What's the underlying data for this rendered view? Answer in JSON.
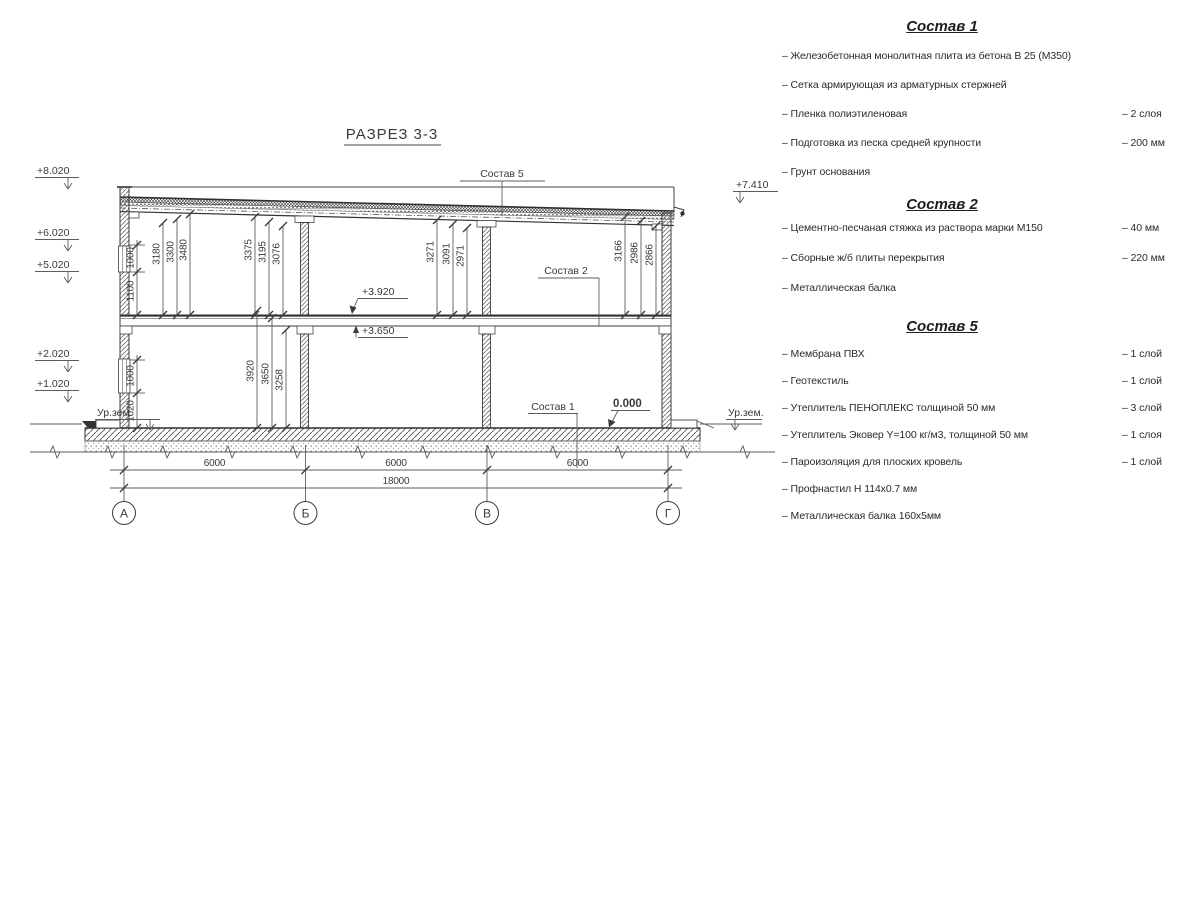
{
  "title": "РАЗРЕЗ 3-3",
  "drawing": {
    "axes": [
      "А",
      "Б",
      "В",
      "Г"
    ],
    "elev_left": [
      "+8.020",
      "+6.020",
      "+5.020",
      "+2.020",
      "+1.020",
      "Ур.зем."
    ],
    "elev_right": [
      "+7.410",
      "Ур.зем."
    ],
    "levels": [
      "+3.920",
      "+3.650",
      "0.000"
    ],
    "leaders": [
      "Состав 5",
      "Состав 2",
      "Состав 1"
    ],
    "dims": {
      "upper_left": [
        "1000",
        "1100"
      ],
      "bay1": [
        "3180",
        "3300",
        "3480"
      ],
      "bay1r": [
        "3375",
        "3195",
        "3076"
      ],
      "bay2": [
        "3271",
        "3091",
        "2971"
      ],
      "bay3": [
        "3166",
        "2986",
        "2866"
      ],
      "lower_left": [
        "1000",
        "1020"
      ],
      "lower": [
        "3920",
        "3650",
        "3258"
      ],
      "horiz": [
        "6000",
        "6000",
        "6000",
        "18000"
      ]
    }
  },
  "compositions": [
    {
      "heading": "Состав 1",
      "items": [
        {
          "name": "– Железобетонная  монолитная плита из бетона В 25 (М350)",
          "qty": ""
        },
        {
          "name": "– Сетка армирующая из арматурных стержней",
          "qty": ""
        },
        {
          "name": "– Пленка полиэтиленовая",
          "qty": "– 2 слоя"
        },
        {
          "name": "– Подготовка из песка средней крупности",
          "qty": "– 200 мм"
        },
        {
          "name": "– Грунт основания",
          "qty": ""
        }
      ]
    },
    {
      "heading": "Состав 2",
      "items": [
        {
          "name": "– Цементно-песчаная стяжка из раствора марки М150",
          "qty": "– 40 мм"
        },
        {
          "name": "– Сборные ж/б плиты перекрытия",
          "qty": "– 220 мм"
        },
        {
          "name": "– Металлическая балка",
          "qty": ""
        }
      ]
    },
    {
      "heading": "Состав 5",
      "items": [
        {
          "name": "– Мембрана ПВХ",
          "qty": "– 1 слой"
        },
        {
          "name": "– Геотекстиль",
          "qty": "– 1 слой"
        },
        {
          "name": "– Утеплитель ПЕНОПЛЕКС толщиной 50 мм",
          "qty": "– 3 слой"
        },
        {
          "name": "– Утеплитель Эковер Y=100 кг/м3, толщиной 50 мм",
          "qty": "– 1 слоя"
        },
        {
          "name": "– Пароизоляция для плоских кровель",
          "qty": "– 1 слой"
        },
        {
          "name": "– Профнастил Н 114х0.7 мм",
          "qty": ""
        },
        {
          "name": "– Металлическая балка 160х5мм",
          "qty": ""
        }
      ]
    }
  ]
}
